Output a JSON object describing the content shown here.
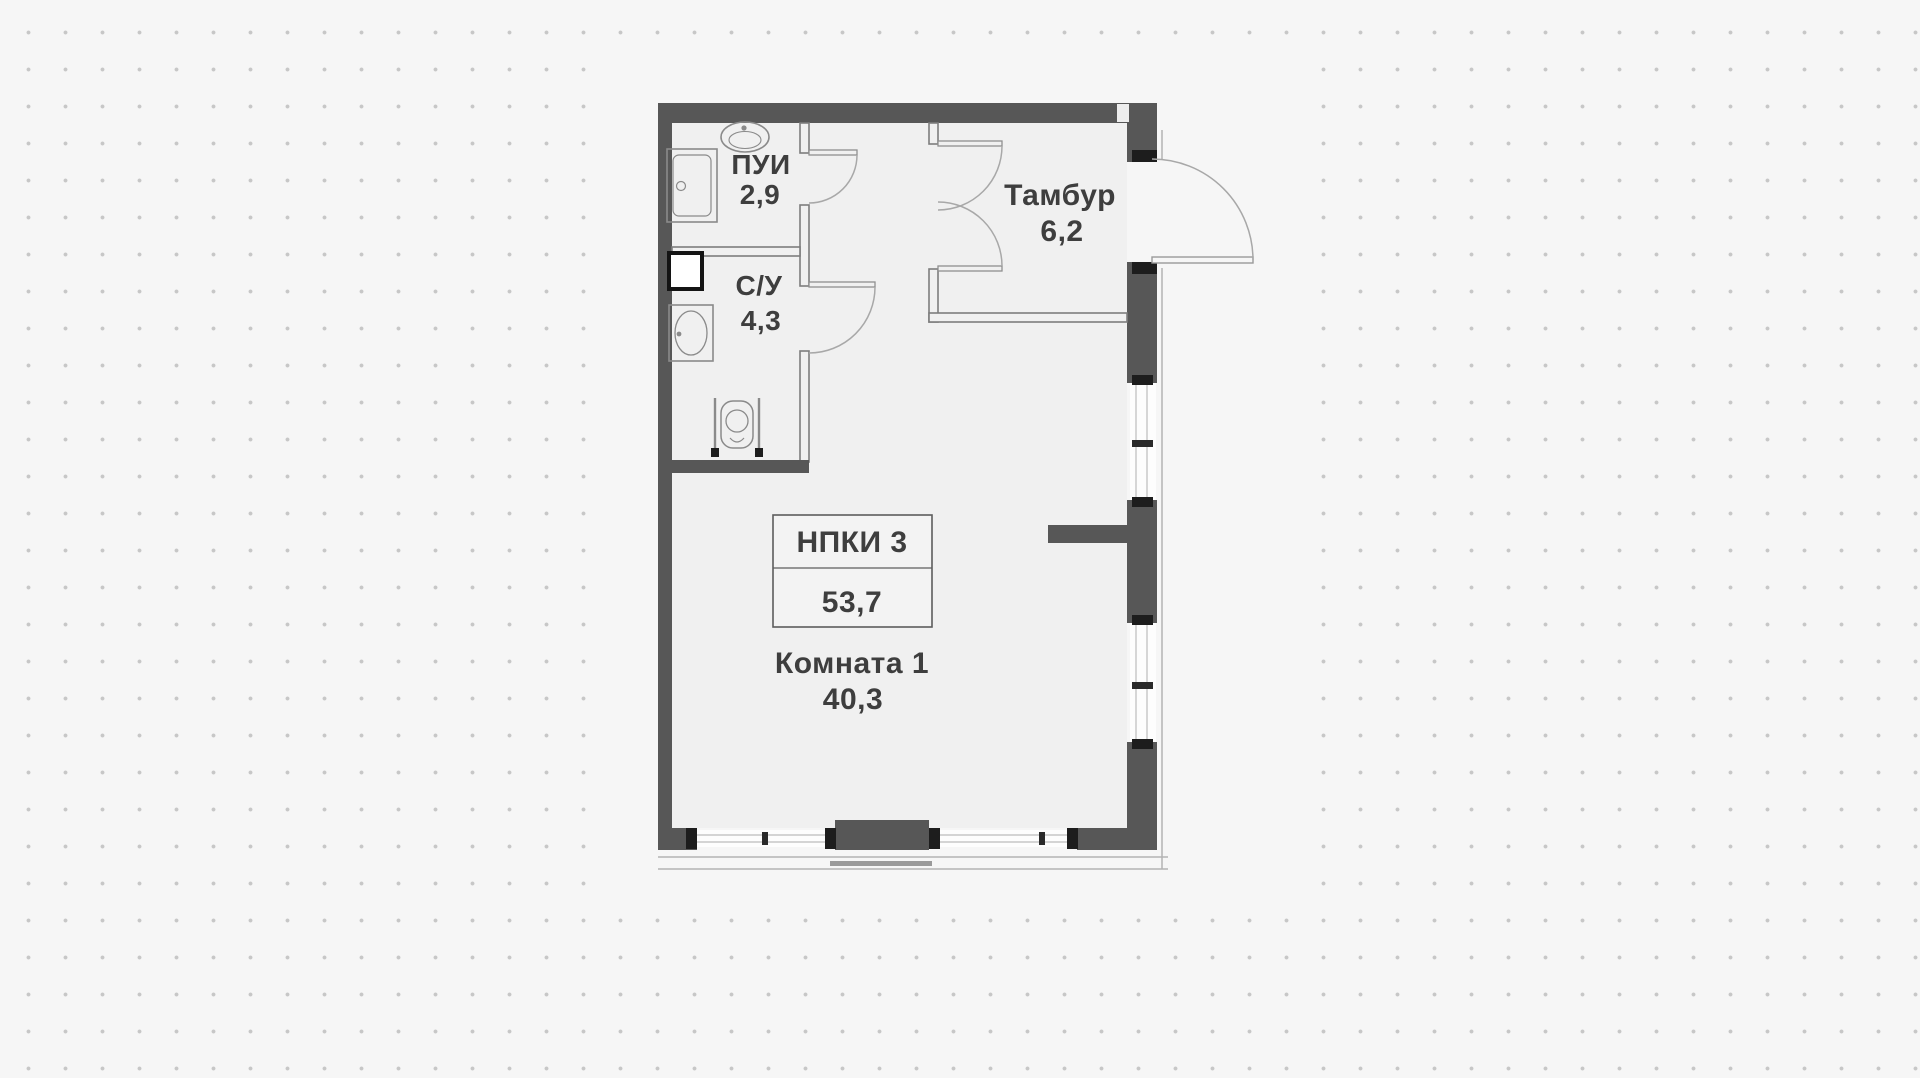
{
  "plan": {
    "unit_box": {
      "line1": "НПКИ 3",
      "line2": "53,7"
    },
    "rooms": [
      {
        "name": "ПУИ",
        "area": "2,9"
      },
      {
        "name": "С/У",
        "area": "4,3"
      },
      {
        "name": "Тамбур",
        "area": "6,2"
      },
      {
        "name": "Комната 1",
        "area": "40,3"
      }
    ],
    "colors": {
      "background": "#f6f6f6",
      "dot": "#c7c7c7",
      "wall": "#575757",
      "floor": "#f0f0f0",
      "partition_line": "#7d7d7d",
      "door_line": "#a0a0a0",
      "fixture_line": "#8a8a8a",
      "tick": "#1d1d1d",
      "window_fill": "#fdfdfd",
      "text": "#3e3e3e"
    }
  }
}
